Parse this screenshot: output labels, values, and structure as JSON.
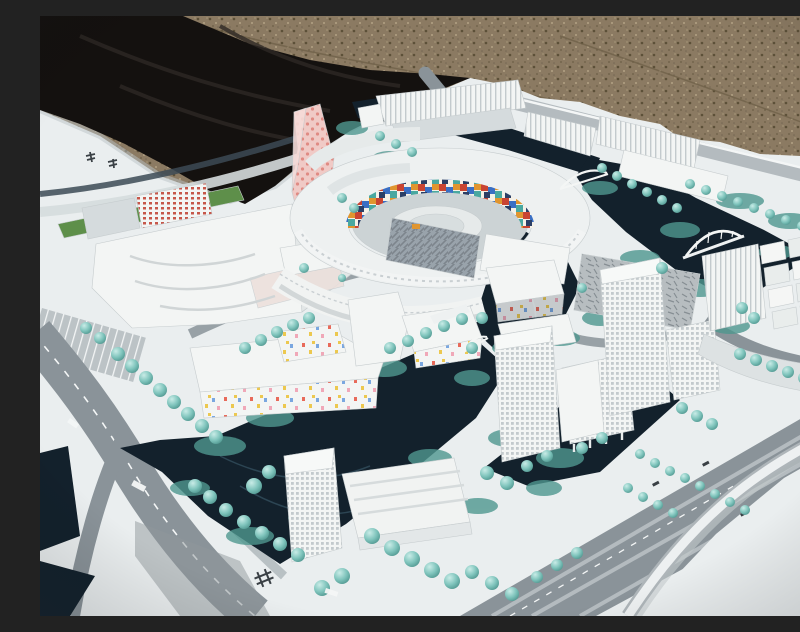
{
  "scene": {
    "title": "Outdoor photograph of a white architectural scale model of a waterfront urban district",
    "environment": {
      "ground": "gravel-pavement",
      "covering": "black-tarp",
      "base": "white-model-board"
    },
    "landmarks": [
      {
        "name": "faceted-pink-tower",
        "note": "twisting high-rise with pink dot facade"
      },
      {
        "name": "oval-courtyard-block",
        "note": "ring building, multicolor mosaic inner wall"
      },
      {
        "name": "confetti-facade-blocks",
        "note": "white mid-rises with scattered color tiles"
      },
      {
        "name": "waterfront-office-tower",
        "note": "gridded tower with podium, lower center"
      },
      {
        "name": "slab-on-pilotis",
        "note": "mid-rise slab raised on stilts"
      },
      {
        "name": "riverside-slab-tower",
        "note": "tall gridded slab at right canal"
      },
      {
        "name": "arched-pedestrian-bridge",
        "note": "white arch over dark canal"
      },
      {
        "name": "curved-highway-ramp",
        "note": "elevated curve at bottom right"
      },
      {
        "name": "canal-network",
        "note": "dark navy water channels"
      },
      {
        "name": "tree-lined-boulevards",
        "note": "rows of translucent teal model trees"
      }
    ],
    "illegible_marks": [
      "board-logo-characters",
      "road-surface-glyph",
      "lane-marking-text"
    ]
  },
  "palette": {
    "gravel": "#8b7a62",
    "gravelDark": "#5c5038",
    "gravelLight": "#b3a284",
    "tarp": "#14110f",
    "tarpFold": "#2d2824",
    "board": "#eaeeef",
    "boardShade": "#d5dbdd",
    "road": "#8a9399",
    "roadDark": "#6e777d",
    "roadLight": "#b4bbbf",
    "marking": "#f4f6f6",
    "water": "#13212c",
    "waterReflect": "#2c4553",
    "greenery": "#7fc4bc",
    "greeneryDark": "#4f978f",
    "grass": "#5e8f4a",
    "building": "#f3f5f4",
    "buildingShade": "#ccd2d3",
    "buildingLine": "#c3cacd",
    "glass": "#99a3ab",
    "sketch": "#b7bdc0",
    "pinkTower": "#f0cac6",
    "pinkDot": "#e08b84",
    "redWindow": "#c6574a",
    "shadow": "#8f979c",
    "glyph": "#3a4045",
    "mosaic": {
      "red": "#c94432",
      "blue": "#3a6fc4",
      "orange": "#e0952f",
      "teal": "#49a8a0",
      "navy": "#2b3f66",
      "white": "#f5f1e8"
    },
    "confetti": {
      "red": "#e86a5a",
      "yellow": "#ecc84f",
      "blue": "#7aa7e0",
      "pink": "#f0a8b8"
    }
  }
}
